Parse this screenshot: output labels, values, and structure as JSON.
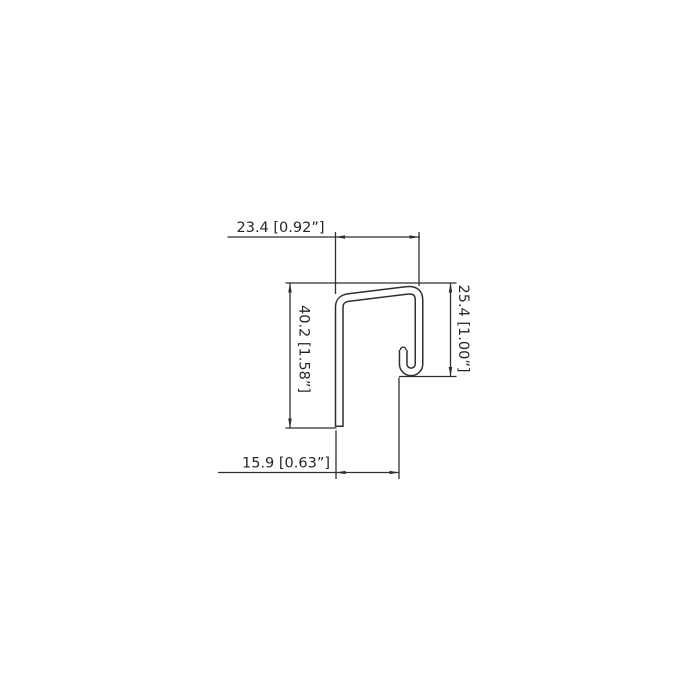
{
  "drawing": {
    "dimensions": {
      "top": {
        "label": "23.4 [0.92”]"
      },
      "left": {
        "label": "40.2 [1.58”]"
      },
      "right": {
        "label": "25.4 [1.00”]"
      },
      "bottom": {
        "label": "15.9 [0.63”]"
      }
    },
    "colors": {
      "line": "#2f2f2f",
      "text": "#262626",
      "background": "#ffffff"
    }
  }
}
